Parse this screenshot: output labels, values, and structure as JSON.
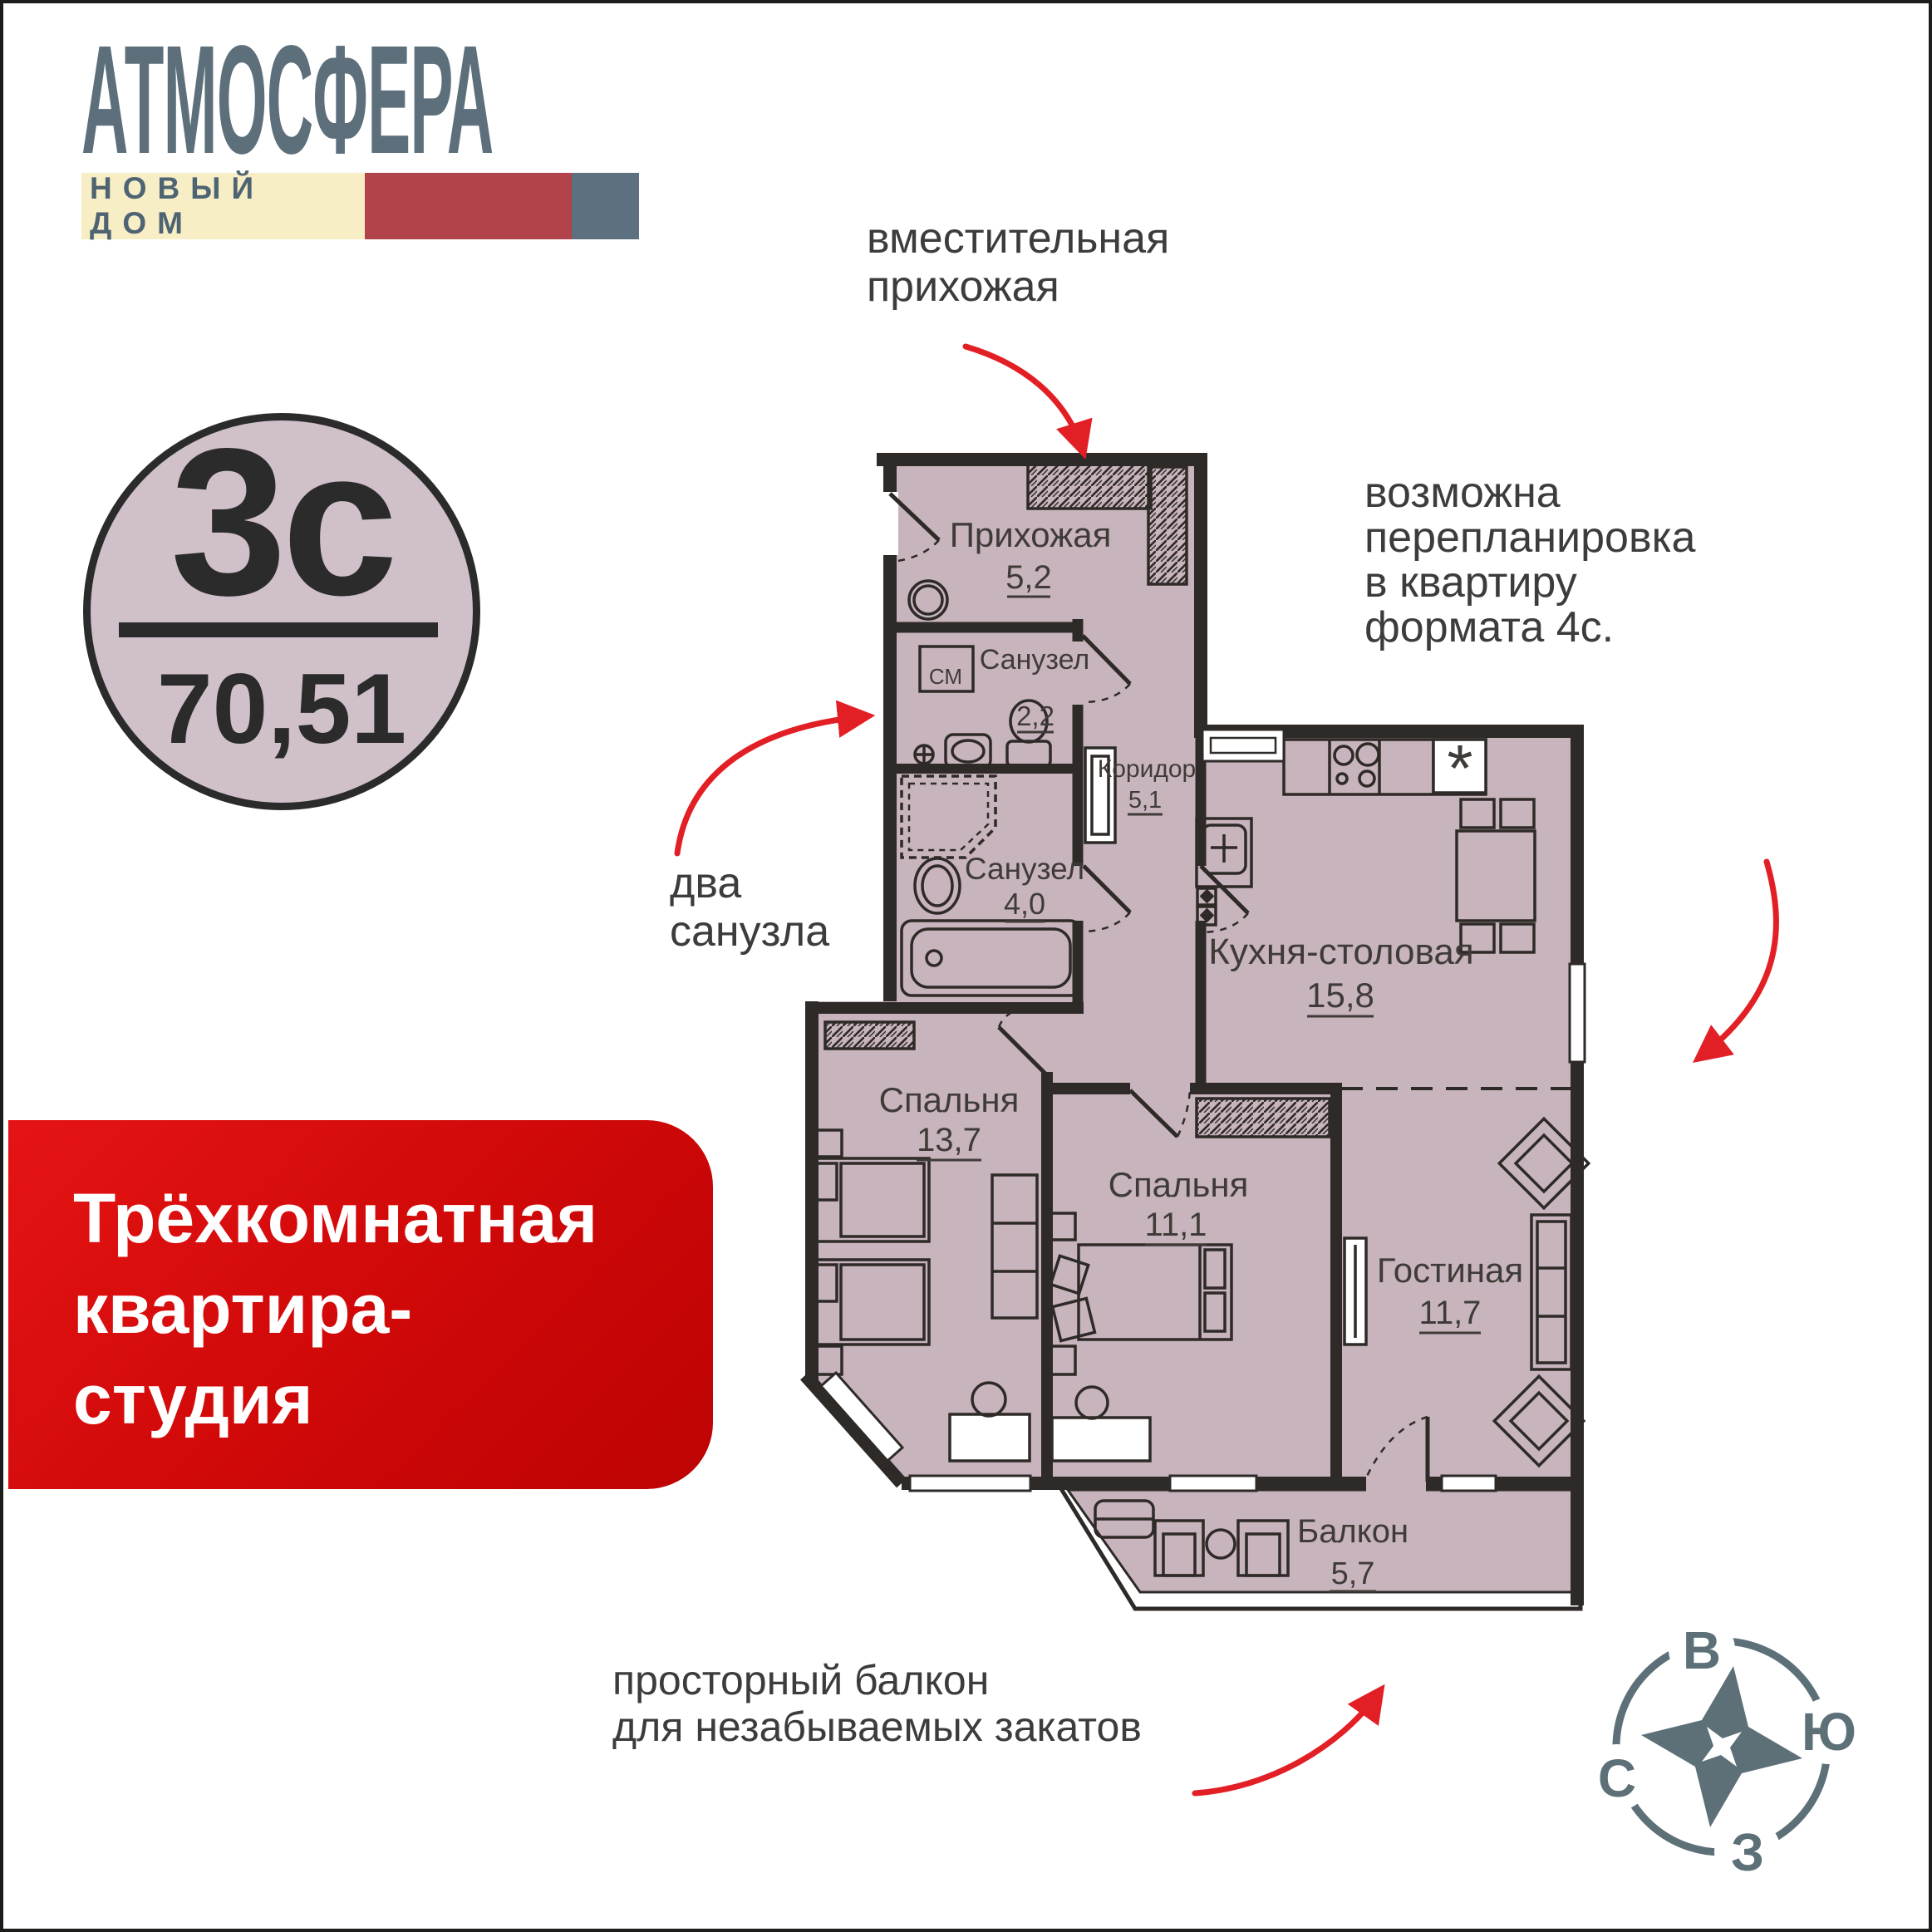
{
  "brand": {
    "name": "АТМОСФЕРА",
    "tagline": "НОВЫЙ ДОМ"
  },
  "badge": {
    "plan_type": "3с",
    "area": "70,51"
  },
  "title_banner": {
    "line1": "Трёхкомнатная",
    "line2": "квартира-",
    "line3": "студия"
  },
  "notes": {
    "hallway_line1": "вместительная",
    "hallway_line2": "прихожая",
    "replan_line1": "возможна",
    "replan_line2": "перепланировка",
    "replan_line3": "в квартиру",
    "replan_line4": "формата 4с.",
    "bath_line1": "два",
    "bath_line2": "санузла",
    "balcony_line1": "просторный балкон",
    "balcony_line2": "для незабываемых закатов"
  },
  "rooms": {
    "hallway": {
      "name": "Прихожая",
      "area": "5,2"
    },
    "bath_small": {
      "name": "Санузел",
      "area": "2,2"
    },
    "corridor": {
      "name": "Коридор",
      "area": "5,1"
    },
    "bath_large": {
      "name": "Санузел",
      "area": "4,0"
    },
    "kitchen": {
      "name": "Кухня-столовая",
      "area": "15,8"
    },
    "bedroom_1": {
      "name": "Спальня",
      "area": "13,7"
    },
    "bedroom_2": {
      "name": "Спальня",
      "area": "11,1"
    },
    "living": {
      "name": "Гостиная",
      "area": "11,7"
    },
    "balcony": {
      "name": "Балкон",
      "area": "5,7"
    },
    "washer_label": "СМ",
    "fridge_symbol": "*"
  },
  "compass": {
    "east": "В",
    "south": "Ю",
    "north": "С",
    "west": "З"
  },
  "colors": {
    "brand_slate": "#5d6f7b",
    "cream": "#f8eec6",
    "brand_red": "#b2434b",
    "floor": "#c8b4bd",
    "wall": "#2e2a27",
    "banner_red": "#d40d10",
    "arrow_red": "#e31f26",
    "text_dark": "#3c3c3c"
  }
}
